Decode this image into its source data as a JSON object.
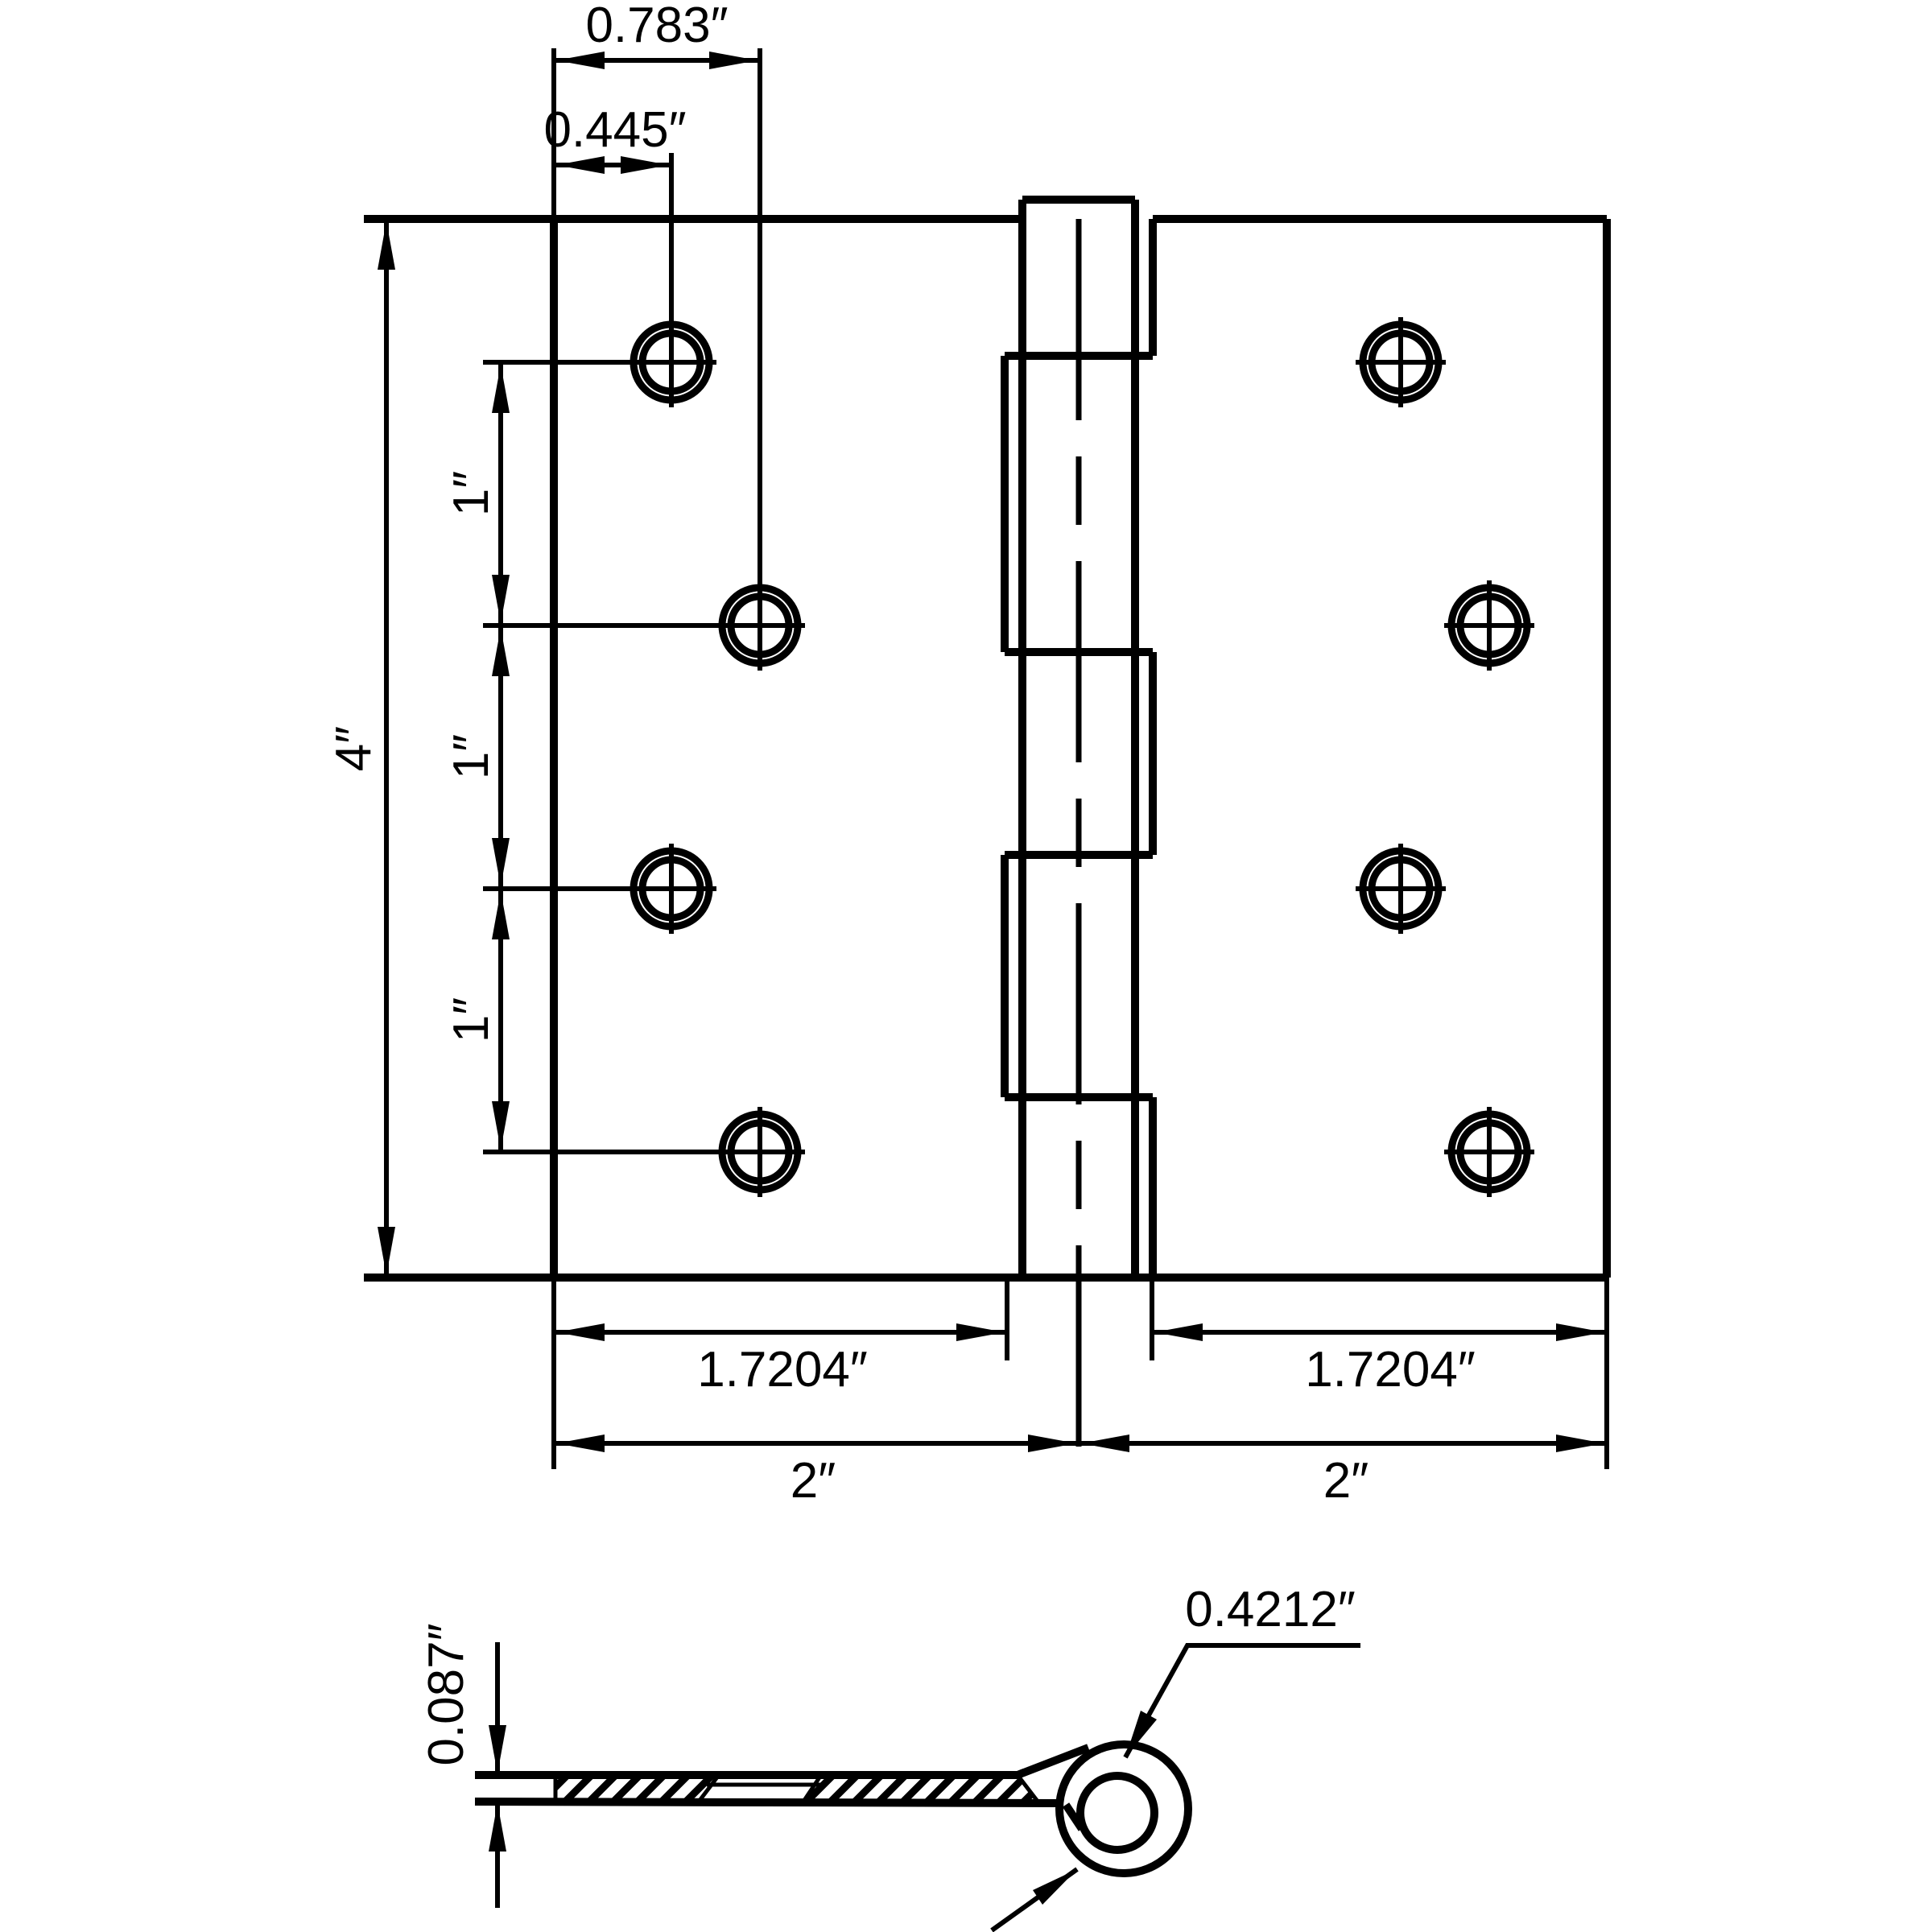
{
  "drawing": {
    "type": "technical-dimension-drawing",
    "subject": "4-inch butt hinge, front view and side section view",
    "colors": {
      "line": "#000000",
      "background": "#ffffff"
    },
    "front_view": {
      "overall_height": "4″",
      "hole_col_offset_outer": "0.783″",
      "hole_col_offset_inner": "0.445″",
      "hole_spacings": [
        "1″",
        "1″",
        "1″"
      ],
      "leaf_flat_width_left": "1.7204″",
      "leaf_flat_width_right": "1.7204″",
      "leaf_width_left": "2″",
      "leaf_width_right": "2″",
      "screw_holes_per_leaf": 4,
      "knuckle_segments": 5
    },
    "side_view": {
      "leaf_thickness": "0.087″",
      "knuckle_outer_diameter": "0.4212″"
    }
  }
}
